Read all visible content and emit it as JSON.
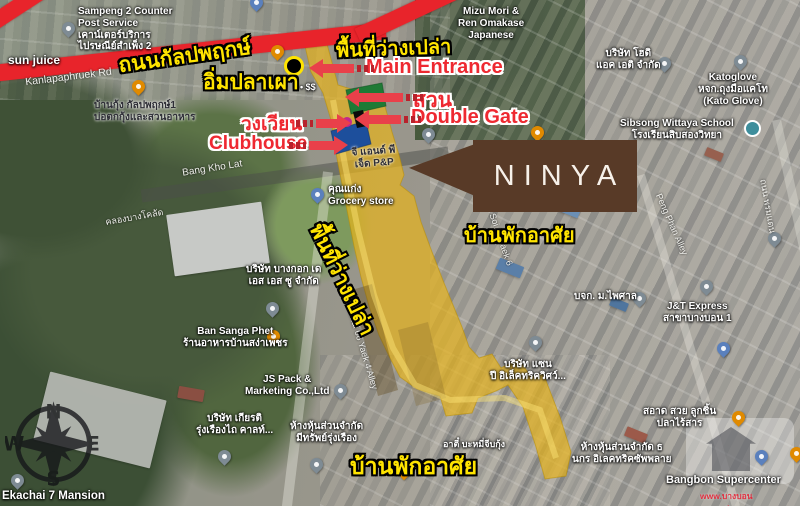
{
  "brand": {
    "name": "NINYA"
  },
  "annotations": {
    "road_th": "ถนนกัลปพฤกษ์",
    "vacant_top": "พื้นที่ว่างเปล่า",
    "vacant_side": "พื้นที่ว่างเปล่า",
    "grill_fish_restaurant": "อิ่มปลาเผา",
    "price_level": "• $$",
    "main_entrance": "Main Entrance",
    "garden": "สวน",
    "double_gate": "Double Gate",
    "roundabout": "วงเวียน",
    "clubhouse": "Clubhouse",
    "residential_right": "บ้านพักอาศัย",
    "residential_bottom": "บ้านพักอาศัย"
  },
  "pois": {
    "sun_juice": "sun juice",
    "sampeng": "Sampeng 2 Counter\nPost Service\nเคาน์เตอร์บริการ\nไปรษณีย์สำเพ็ง 2",
    "mizu": "Mizu Mori &\nRen Omakase\nJapanese",
    "hodi": "บริษัท โฮดิ\nแอค เอติ จำกัด",
    "katoglove": "Katoglove\nหจก.ถุงมือแคโท\n(Kato Glove)",
    "sibsong": "Sibsong Wittaya School\nโรงเรียนสิบสองวิทยา",
    "gnp": "จี แอนด์ พี\nเจ็ด P&P",
    "grocery": "คุณแก่ง\nGrocery store",
    "bangkok_dss": "บริษัท บางกอก เด\nเอส เอส ซู จำกัด",
    "ban_sanga": "Ban Sanga Phet\nร้านอาหารบ้านสง่าเพชร",
    "js_pack": "JS Pack &\nMarketing Co.,Ltd",
    "kiat": "บริษัท เกียรติ\nรุ่งเรืองไถ คาลท์...",
    "meesap": "ห้างหุ้นส่วนจำกัด\nมีทรัพย์รุ่งเรือง",
    "baan_kung": "บ้านกุ้ง กัลปพฤกษ์1\nบ่อตกกุ้งและสวนอาหาร",
    "jnt": "J&T Express\nสาขาบางบอน 1",
    "paisal": "บจก. ม.ไพศาล",
    "san_electric": "บริษัท แซน\nปี อิเล็คทริควิศว์...",
    "saard": "สอาด สวย ลูกชิ้น\nปลาไร้สาร",
    "thanakorn": "ห้างหุ้นส่วนจำกัด ธ\nนกร อิเลคทริคซัพพลาย",
    "bangbon": "Bangbon Supercenter",
    "bangbon_url": "www.บางบอนซุปเปอร์.com",
    "atee": "อาตี๋ บะหมี่จีบกุ้ง",
    "mansion": "Ekachai 7 Mansion"
  },
  "streets": {
    "kanlapaphruek_en": "Kanlapaphruek Rd",
    "bang_kho_lat": "Bang Kho Lat",
    "khlong": "คลองบางโคลัด",
    "ekachai_alley": "Ekachai 66 Yaek 4 Alley",
    "soi11": "Soi 11 Yaek 6",
    "peng_phan": "Peng Phan Alley",
    "promdan": "ถนน พรมแดน"
  },
  "compass": {
    "n": "N",
    "e": "E",
    "s": "S",
    "w": "W"
  },
  "colors": {
    "highway_red": "#e8242b",
    "plot_yellow": "#e7b41c",
    "garden_green": "#1f7a35",
    "clubhouse_blue": "#1d4f9c",
    "roundabout_magenta": "#c2278e",
    "note_yellow": "#ffe400",
    "note_red": "#ee2931",
    "brand_brown": "#583a27"
  }
}
